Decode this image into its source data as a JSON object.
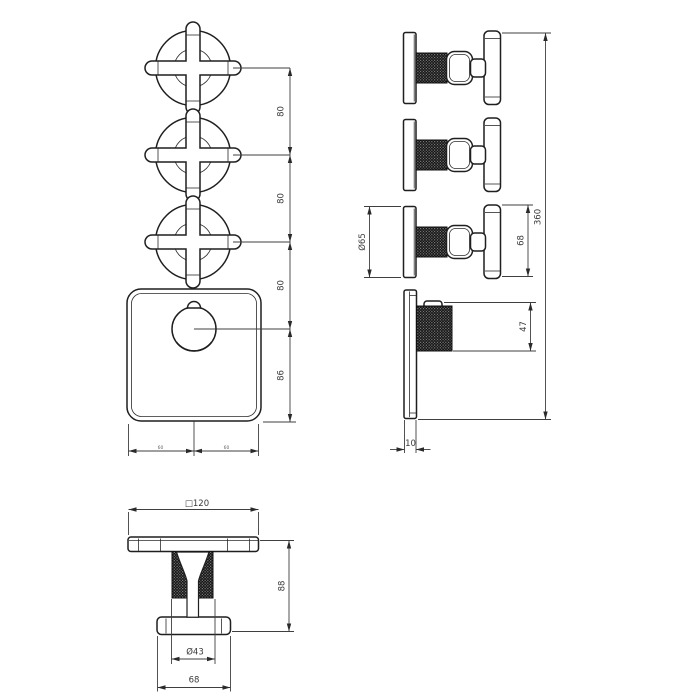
{
  "dims": {
    "spacing_1": "80",
    "spacing_2": "80",
    "spacing_3": "80",
    "knob_offset": "86",
    "half_width_left": "60",
    "half_width_right": "60",
    "handle_diameter": "Ø65",
    "handle_height": "68",
    "total_height": "360",
    "knob_depth": "47",
    "plate_thickness": "10",
    "plate_size": "□120",
    "handle_depth": "88",
    "grip_diameter": "Ø43",
    "handle_length": "68"
  },
  "colors": {
    "line": "#1f1f1f",
    "dimension": "#3f3f3f",
    "knurl": "#101010",
    "background": "#ffffff"
  }
}
